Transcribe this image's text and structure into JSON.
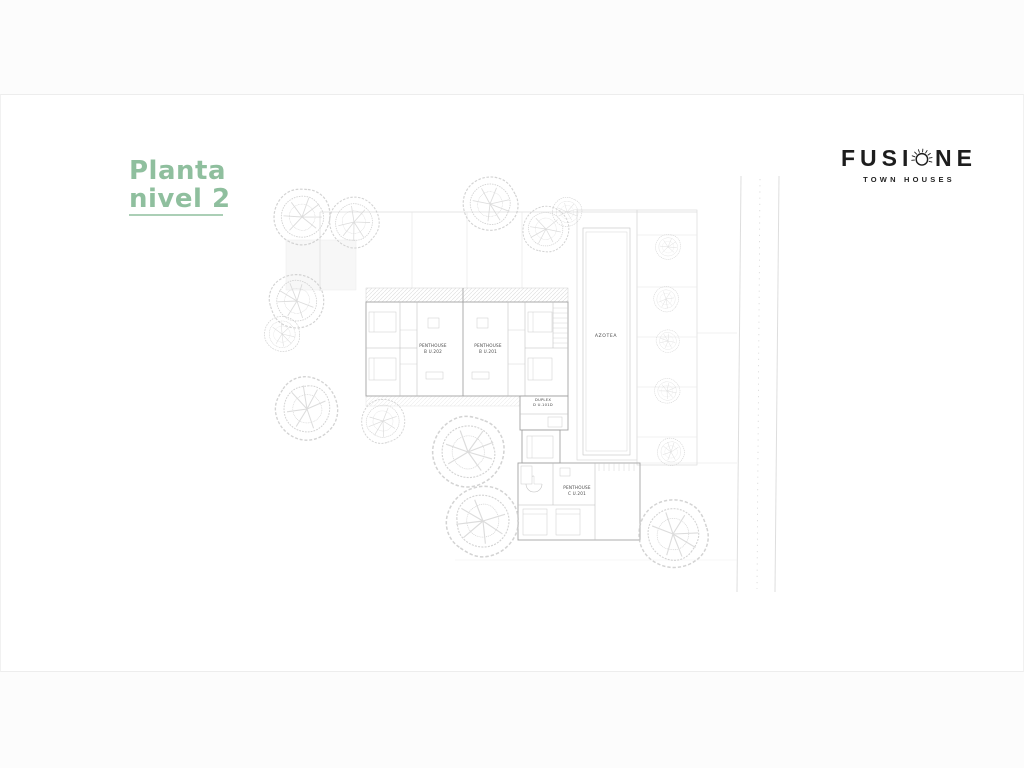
{
  "theme": {
    "accent": "#8fbf9e",
    "ink": "#1d1d1d"
  },
  "title": {
    "line1": "Planta",
    "line2": "nivel 2"
  },
  "logo": {
    "brand_left": "FUSI",
    "brand_right": "NE",
    "brand_full": "FUSIONE",
    "subtitle": "TOWN HOUSES"
  },
  "plan": {
    "labels": {
      "unit_b202": [
        "PENTHOUSE",
        "B U.202"
      ],
      "unit_b201": [
        "PENTHOUSE",
        "B U.201"
      ],
      "azotea": "AZOTEA",
      "duplex": [
        "DUPLEX",
        "D U.101D"
      ],
      "unit_c201": [
        "PENTHOUSE",
        "C U.201"
      ]
    }
  }
}
